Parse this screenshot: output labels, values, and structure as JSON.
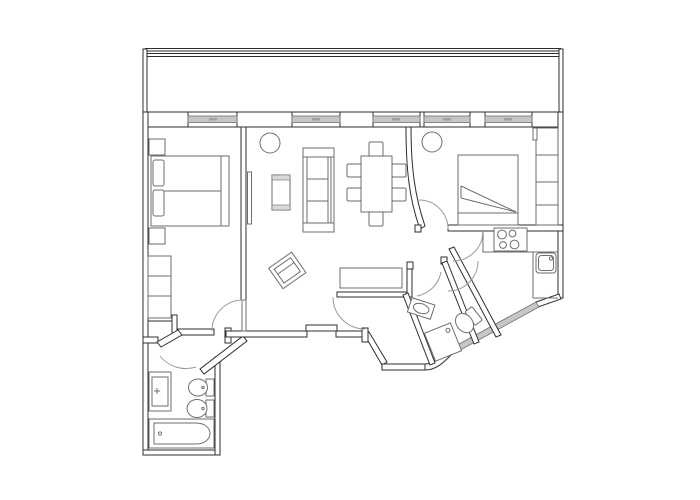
{
  "meta": {
    "label": "Black and white architectural floor plan of an apartment with terrace, two bedrooms, living-dining room, kitchen, bathroom, shower room and WC"
  },
  "colors": {
    "background": "#ffffff",
    "wall_line": "#2e2e2e",
    "furniture_line": "#6e6e6e",
    "door_arc": "#9a9a9a",
    "window_sill": "#c4c7c9",
    "window_tick": "#9da1a3",
    "shade": "#d9d9d9"
  },
  "rooms": [
    {
      "name": "terrace",
      "fixtures": [
        "railing"
      ]
    },
    {
      "name": "bedroom-left",
      "fixtures": [
        "double-bed",
        "two-pillows",
        "nightstand-top",
        "nightstand-bottom",
        "wardrobe"
      ]
    },
    {
      "name": "living-dining-room",
      "fixtures": [
        "sofa",
        "coffee-table",
        "wall-tv",
        "dining-table",
        "six-chairs",
        "armchair",
        "console-table",
        "plant"
      ]
    },
    {
      "name": "bedroom-right",
      "fixtures": [
        "double-bed-with-folded-blanket",
        "wardrobe",
        "plant"
      ]
    },
    {
      "name": "kitchen",
      "fixtures": [
        "counter",
        "four-burner-stove",
        "sink"
      ]
    },
    {
      "name": "shower-room",
      "fixtures": [
        "washbasin",
        "shower-tray"
      ]
    },
    {
      "name": "wc",
      "fixtures": [
        "toilet"
      ]
    },
    {
      "name": "bathroom",
      "fixtures": [
        "vanity-sink",
        "bidet",
        "toilet",
        "bathtub"
      ]
    },
    {
      "name": "hallway",
      "fixtures": []
    }
  ],
  "windows": {
    "top_wall_count": 5,
    "angled_bay_window": 1
  }
}
